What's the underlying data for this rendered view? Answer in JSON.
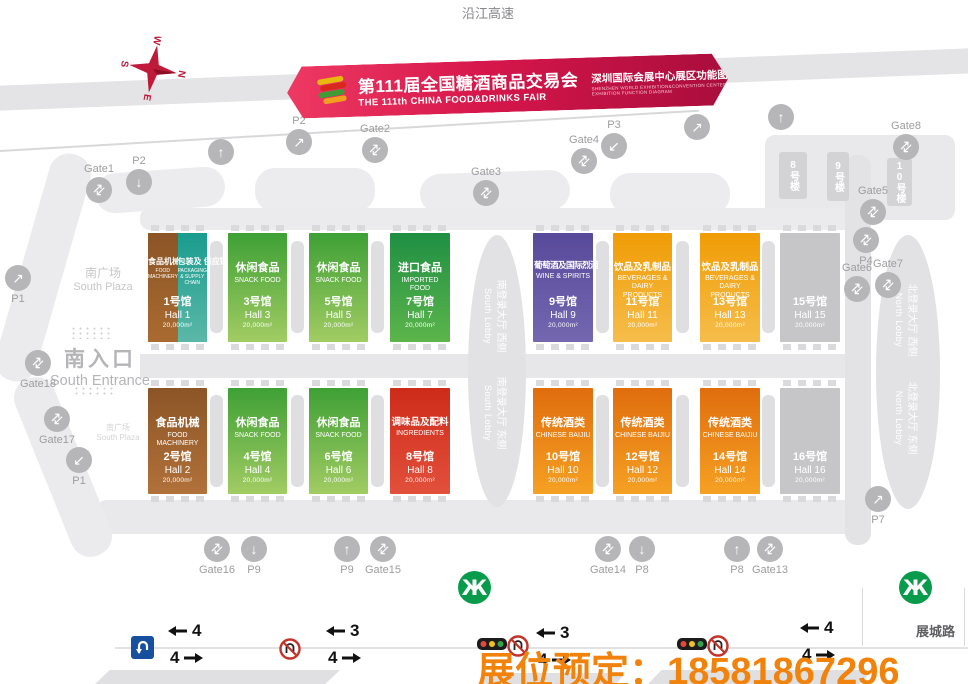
{
  "page": {
    "expressway": "沿江高速",
    "road_name": "展城路",
    "hotline": "展位预定：18581867296",
    "hotline_color": "#f1830c",
    "banner_color": "#d6164b"
  },
  "banner": {
    "title_cn": "第111届全国糖酒商品交易会",
    "title_en": "THE 111th CHINA FOOD&DRINKS FAIR",
    "venue_cn": "深圳国际会展中心展区功能图",
    "venue_en_1": "SHENZHEN WORLD EXHIBITION&CONVENTION CENTER",
    "venue_en_2": "EXHIBITION FUNCTION DIAGRAM"
  },
  "compass": {
    "n": "N",
    "s": "S",
    "e": "E",
    "w": "W"
  },
  "labels": {
    "south_plaza_cn": "南广场",
    "south_plaza_en": "South Plaza",
    "south_entrance_cn": "南入口",
    "south_entrance_en": "South Entrance",
    "south_plaza_small_cn": "南广场",
    "south_plaza_small_en": "South Plaza",
    "towers": [
      "8号楼",
      "9号楼",
      "10号楼"
    ],
    "south_lobby_west_cn": "南登录大厅 西侧",
    "south_lobby_east_cn": "南登录大厅 东侧",
    "south_lobby_en": "South Lobby",
    "north_lobby_west_cn": "北登录大厅 西侧",
    "north_lobby_east_cn": "北登录大厅 东侧",
    "north_lobby_en": "North Lobby"
  },
  "halls": [
    {
      "id": "hall-1",
      "theme": "split",
      "split": true,
      "left": {
        "cat_cn": "食品机械",
        "cat_en": "FOOD MACHINERY"
      },
      "right": {
        "cat_cn": "包装及 供应链",
        "cat_en": "PACKAGING & SUPPLY CHAIN"
      },
      "no_cn": "1号馆",
      "no_en": "Hall 1",
      "area": "20,000m²"
    },
    {
      "id": "hall-3",
      "theme": "green",
      "cat_cn": "休闲食品",
      "cat_en": "SNACK FOOD",
      "no_cn": "3号馆",
      "no_en": "Hall 3",
      "area": "20,000m²"
    },
    {
      "id": "hall-5",
      "theme": "green",
      "cat_cn": "休闲食品",
      "cat_en": "SNACK FOOD",
      "no_cn": "5号馆",
      "no_en": "Hall 5",
      "area": "20,000m²"
    },
    {
      "id": "hall-7",
      "theme": "deepgreen",
      "cat_cn": "进口食品",
      "cat_en": "IMPORTED FOOD",
      "no_cn": "7号馆",
      "no_en": "Hall 7",
      "area": "20,000m²"
    },
    {
      "id": "hall-9",
      "theme": "purple",
      "cat_cn": "葡萄酒及国际烈酒",
      "cat_en": "WINE & SPIRITS",
      "no_cn": "9号馆",
      "no_en": "Hall 9",
      "area": "20,000m²"
    },
    {
      "id": "hall-11",
      "theme": "gold",
      "cat_cn": "饮品及乳制品",
      "cat_en": "BEVERAGES & DAIRY PRODUCTS",
      "no_cn": "11号馆",
      "no_en": "Hall 11",
      "area": "20,000m²"
    },
    {
      "id": "hall-13",
      "theme": "gold",
      "cat_cn": "饮品及乳制品",
      "cat_en": "BEVERAGES & DAIRY PRODUCTS",
      "no_cn": "13号馆",
      "no_en": "Hall 13",
      "area": "20,000m²"
    },
    {
      "id": "hall-15",
      "theme": "gray",
      "cat_cn": "",
      "cat_en": "",
      "no_cn": "15号馆",
      "no_en": "Hall 15",
      "area": "20,000m²"
    },
    {
      "id": "hall-2",
      "theme": "brown",
      "cat_cn": "食品机械",
      "cat_en": "FOOD MACHINERY",
      "no_cn": "2号馆",
      "no_en": "Hall 2",
      "area": "20,000m²"
    },
    {
      "id": "hall-4",
      "theme": "green",
      "cat_cn": "休闲食品",
      "cat_en": "SNACK FOOD",
      "no_cn": "4号馆",
      "no_en": "Hall 4",
      "area": "20,000m²"
    },
    {
      "id": "hall-6",
      "theme": "green",
      "cat_cn": "休闲食品",
      "cat_en": "SNACK FOOD",
      "no_cn": "6号馆",
      "no_en": "Hall 6",
      "area": "20,000m²"
    },
    {
      "id": "hall-8",
      "theme": "red",
      "cat_cn": "调味品及配料",
      "cat_en": "INGREDIENTS",
      "no_cn": "8号馆",
      "no_en": "Hall 8",
      "area": "20,000m²"
    },
    {
      "id": "hall-10",
      "theme": "orange",
      "cat_cn": "传统酒类",
      "cat_en": "CHINESE BAIJIU",
      "no_cn": "10号馆",
      "no_en": "Hall 10",
      "area": "20,000m²"
    },
    {
      "id": "hall-12",
      "theme": "orange",
      "cat_cn": "传统酒类",
      "cat_en": "CHINESE BAIJIU",
      "no_cn": "12号馆",
      "no_en": "Hall 12",
      "area": "20,000m²"
    },
    {
      "id": "hall-14",
      "theme": "orange",
      "cat_cn": "传统酒类",
      "cat_en": "CHINESE BAIJIU",
      "no_cn": "14号馆",
      "no_en": "Hall 14",
      "area": "20,000m²"
    },
    {
      "id": "hall-16",
      "theme": "gray",
      "cat_cn": "",
      "cat_en": "",
      "no_cn": "16号馆",
      "no_en": "Hall 16",
      "area": "20,000m²"
    }
  ],
  "markers": [
    {
      "label": "Gate1",
      "kind": "gate"
    },
    {
      "label": "P2",
      "kind": "park-down"
    },
    {
      "label": "",
      "kind": "arrow-up"
    },
    {
      "label": "P2",
      "kind": "park-ne"
    },
    {
      "label": "Gate2",
      "kind": "gate"
    },
    {
      "label": "Gate3",
      "kind": "gate"
    },
    {
      "label": "Gate4",
      "kind": "gate"
    },
    {
      "label": "P3",
      "kind": "park-se"
    },
    {
      "label": "",
      "kind": "arrow-ne"
    },
    {
      "label": "",
      "kind": "arrow-up"
    },
    {
      "label": "Gate8",
      "kind": "gate"
    },
    {
      "label": "Gate5",
      "kind": "gate"
    },
    {
      "label": "P4",
      "kind": "gate"
    },
    {
      "label": "Gate6",
      "kind": "gate"
    },
    {
      "label": "Gate7",
      "kind": "gate"
    },
    {
      "label": "P1",
      "kind": "arrow-ne"
    },
    {
      "label": "Gate18",
      "kind": "gate"
    },
    {
      "label": "Gate17",
      "kind": "gate"
    },
    {
      "label": "P1",
      "kind": "park-se"
    },
    {
      "label": "Gate16",
      "kind": "gate"
    },
    {
      "label": "P9",
      "kind": "park-down"
    },
    {
      "label": "P9",
      "kind": "arrow-up"
    },
    {
      "label": "Gate15",
      "kind": "gate"
    },
    {
      "label": "Gate14",
      "kind": "gate"
    },
    {
      "label": "P8",
      "kind": "park-down"
    },
    {
      "label": "P8",
      "kind": "arrow-up"
    },
    {
      "label": "Gate13",
      "kind": "gate"
    },
    {
      "label": "P7",
      "kind": "arrow-ne"
    }
  ],
  "road": {
    "lanes": [
      {
        "top": "4",
        "bottom": "4"
      },
      {
        "top": "3",
        "bottom": "4"
      },
      {
        "top": "3",
        "bottom": "4"
      },
      {
        "top": "4",
        "bottom": "4"
      }
    ]
  }
}
